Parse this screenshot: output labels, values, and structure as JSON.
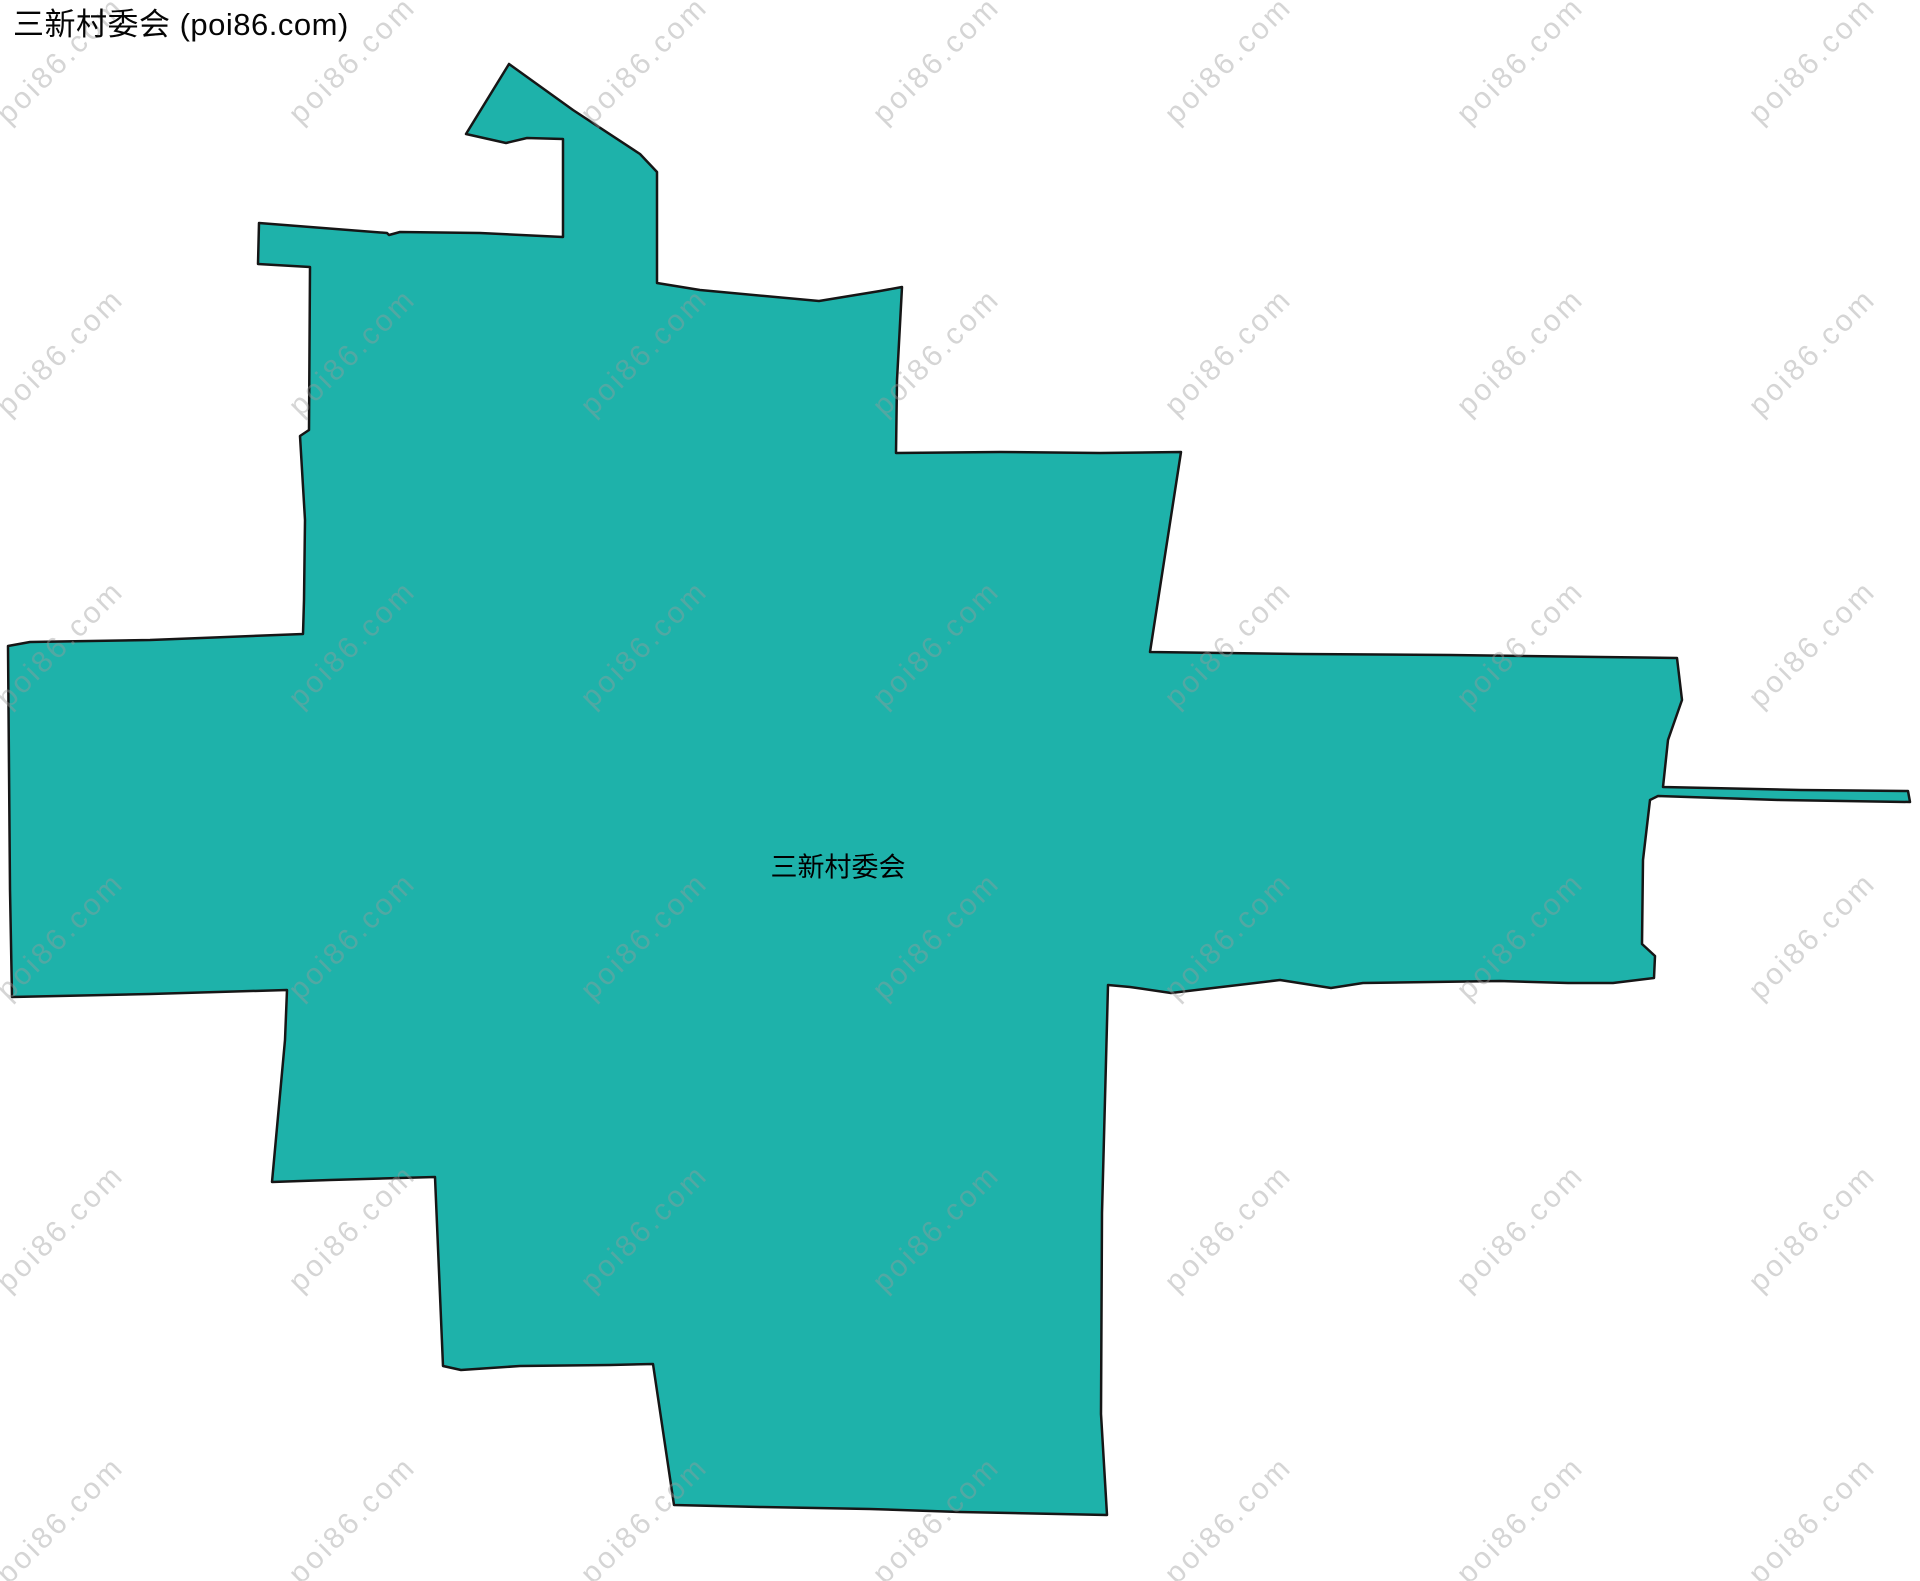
{
  "title": "三新村委会 (poi86.com)",
  "map": {
    "region_label": "三新村委会",
    "fill_color": "#1EB2AA",
    "stroke_color": "#161616",
    "stroke_width": "2.5",
    "polygon_points": "509,64 573,110 640,154 657,172 657,283 700,290 819,301 880,291 902,287 897,380 896,453 1000,452 1100,453 1181,452 1150,652 1300,654 1450,655 1600,657 1677,658 1682,700 1668,740 1663,787 1800,790 1908,791 1910,802 1780,800 1658,796 1650,800 1643,860 1642,944 1655,956 1654,978 1613,983 1568,983 1500,981 1363,983 1331,988 1280,980 1171,993 1130,987 1108,985 1102,1213 1101,1414 1107,1515 960,1512 870,1509 760,1507 674,1505 653,1364 610,1365 520,1366 461,1370 443,1366 435,1177 330,1180 272,1182 285,1040 287,990 150,994 12,997 10,890 8,646 30,642 150,640 303,634 304,600 305,520 300,436 309,430 310,267 258,264 259,223 387,233 389,235 400,232 480,233 563,237 563,139 527,138 506,143 466,134"
  },
  "watermark": {
    "text": "poi86.com",
    "color": "#9a9a9a",
    "opacity": "0.42"
  }
}
